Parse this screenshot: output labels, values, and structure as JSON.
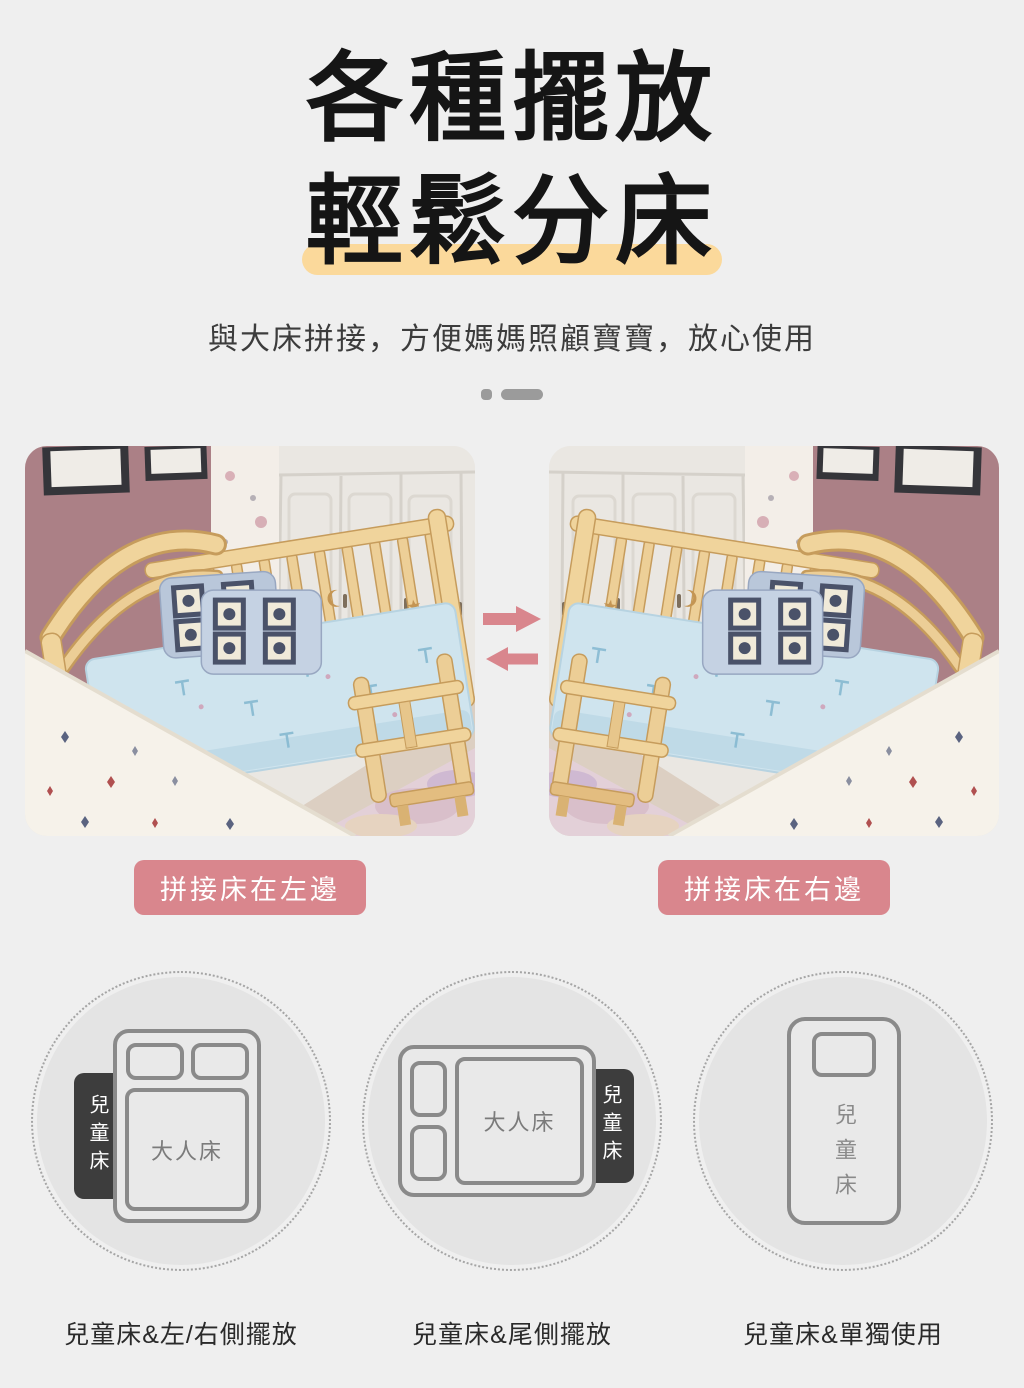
{
  "header": {
    "title_line1": "各種擺放",
    "title_line2": "輕鬆分床",
    "subtitle": "與大床拼接，方便媽媽照顧寶寶，放心使用"
  },
  "gallery": {
    "left_caption": "拼接床在左邊",
    "right_caption": "拼接床在右邊"
  },
  "arrangements": [
    {
      "caption": "兒童床&左/右側擺放",
      "child_label": "兒童床",
      "adult_label": "大人床"
    },
    {
      "caption": "兒童床&尾側擺放",
      "child_label": "兒童床",
      "adult_label": "大人床"
    },
    {
      "caption": "兒童床&單獨使用",
      "child_label": "兒童床"
    }
  ],
  "colors": {
    "page_background": "#efefef",
    "accent_pink": "#d9868d",
    "highlight_yellow": "#fbd99b",
    "tag_dark": "#3d3d3d"
  }
}
